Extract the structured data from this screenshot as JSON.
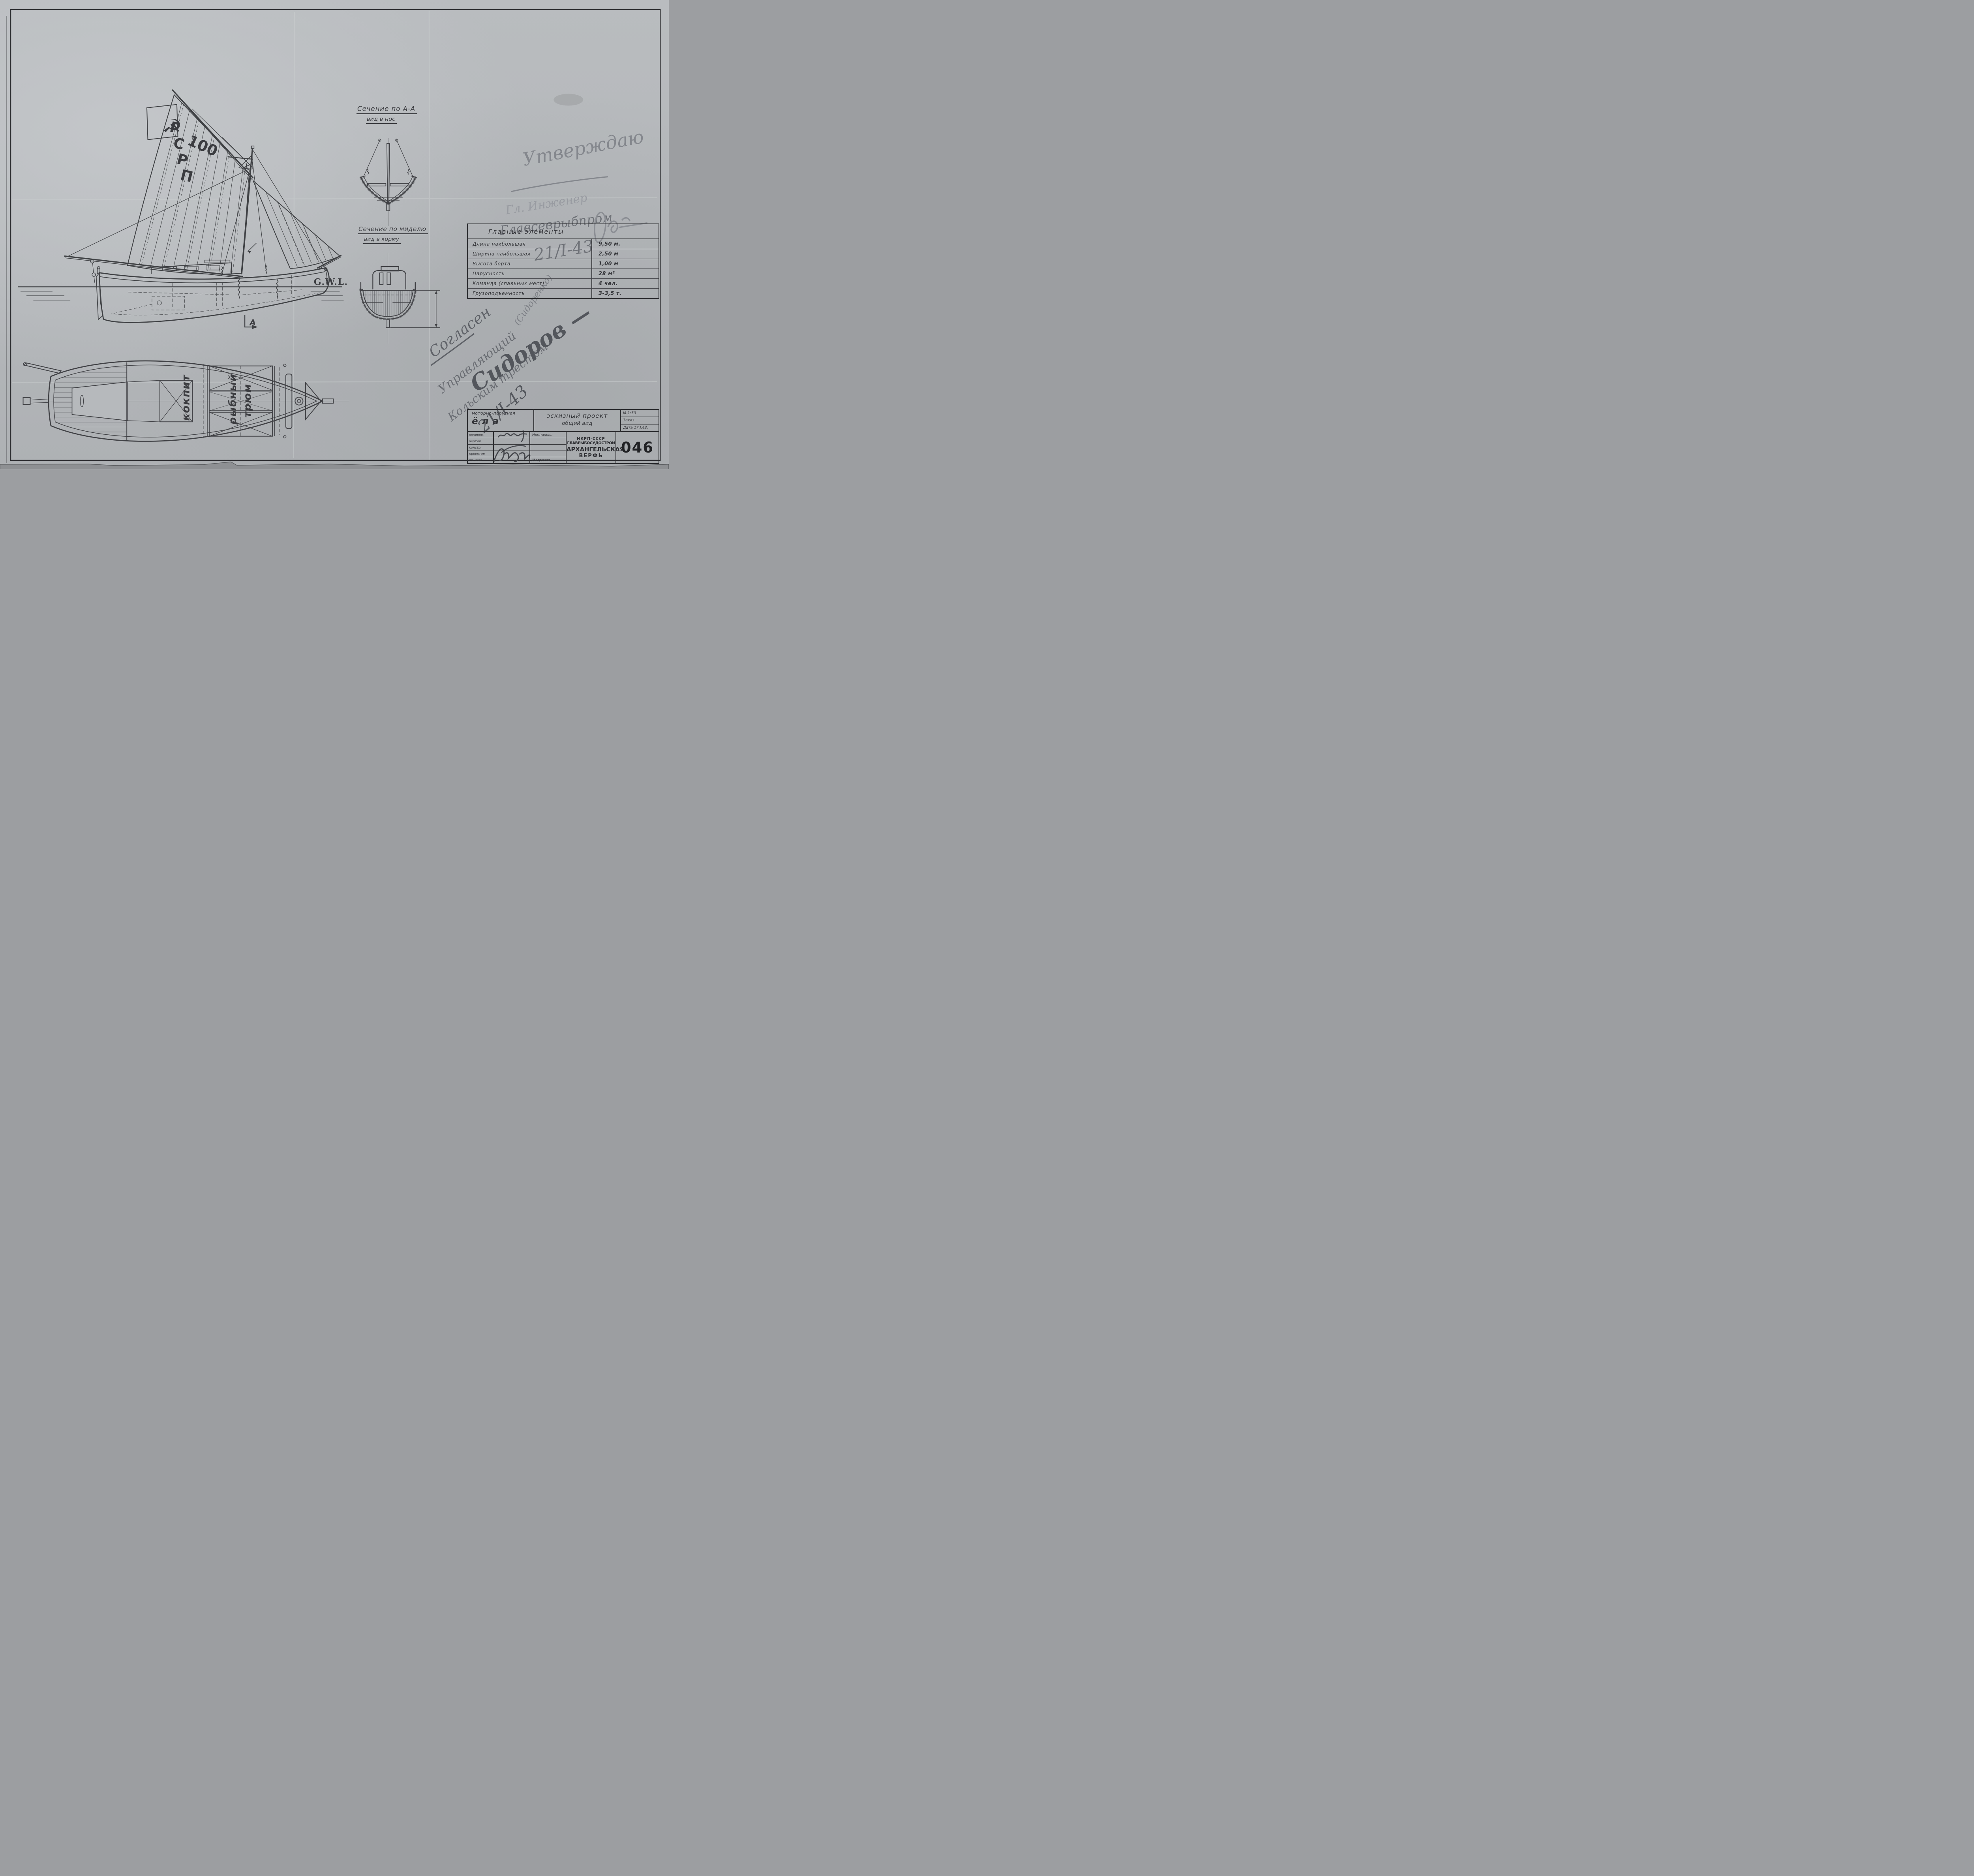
{
  "colors": {
    "paper": "#b6b9bc",
    "ink": "#3d3e42",
    "pencil": "#83868c",
    "pencil_dark": "#5d6066",
    "frame": "#303134"
  },
  "drawing": {
    "flag_symbol": "☭",
    "pennant_mark": "x",
    "sail_letters": [
      "Г",
      "С",
      "Р",
      "П"
    ],
    "sail_number": "100",
    "waterline_label": "G.W.L.",
    "section_marker": "А",
    "plan": {
      "cockpit": "кокпит",
      "fish_hold_line1": "рыбный",
      "fish_hold_line2": "трюм"
    }
  },
  "sections": {
    "aa": {
      "title": "Сечение по А-А",
      "subtitle": "вид в нос"
    },
    "midship": {
      "title": "Сечение по миделю",
      "subtitle": "вид в корму"
    }
  },
  "approval": {
    "stamp": "Утверждаю",
    "role": "Гл. Инженер",
    "org": "Главсеврыбпром",
    "date": "21/I-43"
  },
  "agreement": {
    "stamp": "Согласен",
    "role": "Управляющий",
    "org": "Кольским трестом",
    "signature": "Сидоров —",
    "note": "(Сидоренко)",
    "date": "21/I-43"
  },
  "table": {
    "title": "Главные элементы",
    "rows": [
      {
        "label": "Длина наибольшая",
        "value": "9,50 м."
      },
      {
        "label": "Ширина наибольшая",
        "value": "2,50 м"
      },
      {
        "label": "Высота борта",
        "value": "1,00 м"
      },
      {
        "label": "Парусность",
        "value": "28 м²"
      },
      {
        "label": "Команда (спальных мест)",
        "value": "4 чел."
      },
      {
        "label": "Грузоподъемность",
        "value": "3-3,5 т."
      }
    ]
  },
  "titleblock": {
    "vessel_type": "моторно-парусная",
    "vessel_name": "ёла",
    "project": "эскизный проект",
    "view": "общий вид",
    "scale": "М-1:50",
    "order": "Заказ",
    "date": "Дата 17.I.43.",
    "roles": [
      "копиров.",
      "чертил",
      "констр.",
      "проектир",
      "гл. инж"
    ],
    "names": {
      "copier": "Нянникова",
      "chief_engineer": "Матросов"
    },
    "org_line1": "НКРП-СССР",
    "org_line2": "ГЛАВРЫБОСУДОСТРОЙ",
    "org_line3": "АРХАНГЕЛЬСКАЯ",
    "org_line4": "ВЕРФЬ",
    "number": "046"
  }
}
